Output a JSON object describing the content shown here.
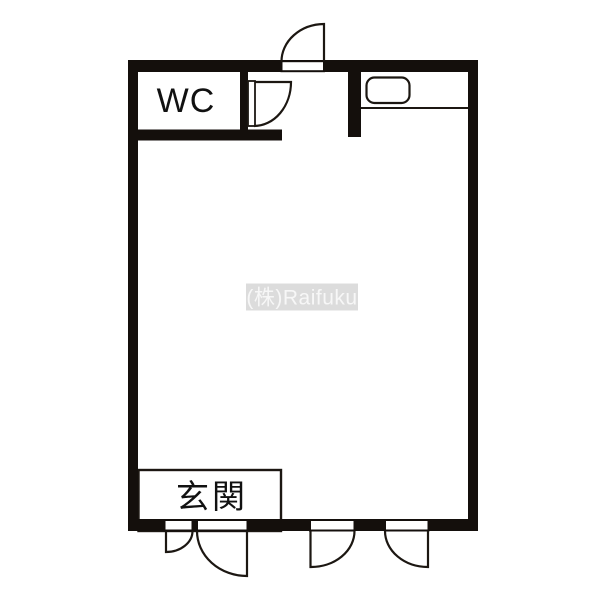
{
  "colors": {
    "background": "#ffffff",
    "wall": "#140f0c",
    "line": "#1c1712",
    "watermark_bg": "#dcdcdc",
    "watermark_text": "#f7f7f7"
  },
  "floorplan": {
    "labels": {
      "wc": "WC",
      "genkan": "玄関"
    },
    "watermark_text": "(株)Raifuku"
  }
}
